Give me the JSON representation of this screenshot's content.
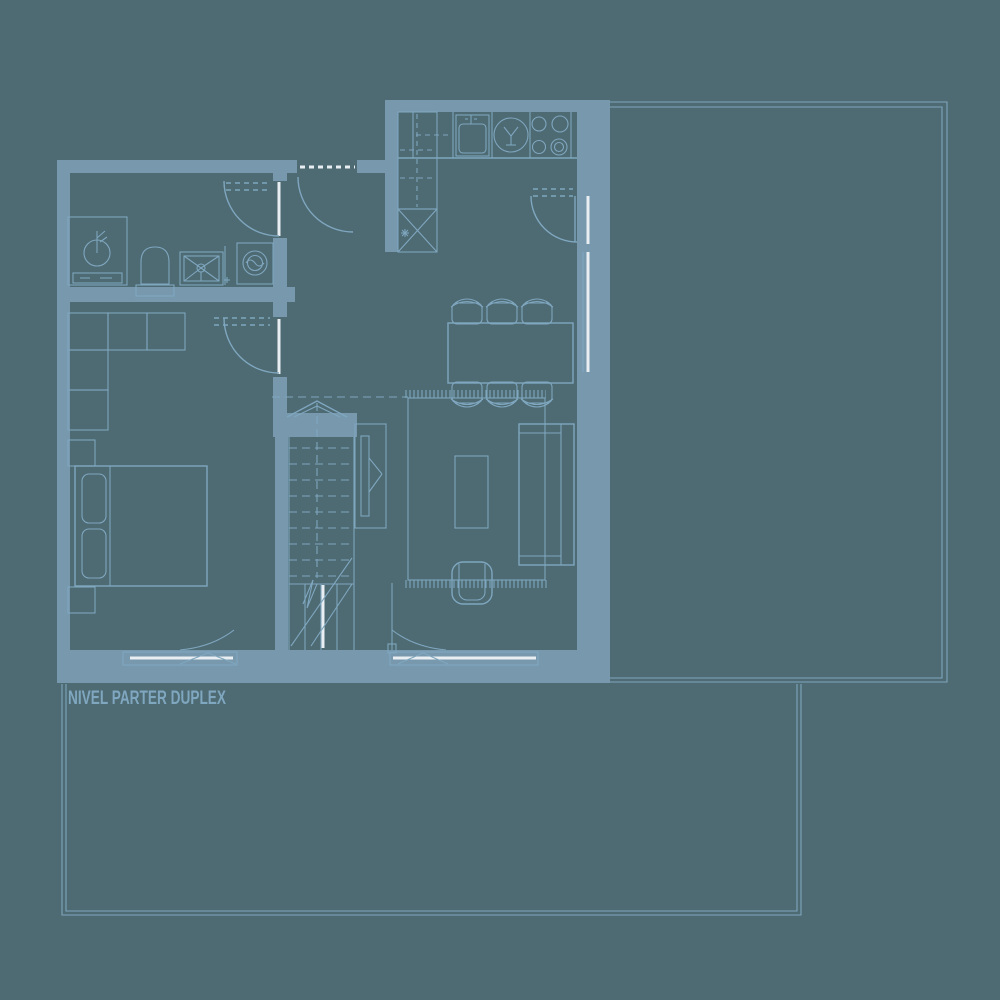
{
  "plan_label": {
    "text": "NIVEL PARTER DUPLEX"
  },
  "colors": {
    "background": "#4e6a73",
    "wall": "#7798ad",
    "line": "#7fa7bf",
    "glass": "#e8eef1"
  },
  "symbols": [
    "washbasin",
    "toilet",
    "shower",
    "washing-machine",
    "kitchen-sink",
    "round-basin",
    "cooktop",
    "refrigerator",
    "tall-cabinet",
    "dining-table",
    "dining-chair",
    "rug",
    "sofa",
    "coffee-table",
    "armchair",
    "tv-unit",
    "wardrobe",
    "bed",
    "pillow",
    "nightstand",
    "stairs",
    "direction-arrow",
    "door-swing",
    "window",
    "entry-threshold",
    "terrace-outline"
  ]
}
